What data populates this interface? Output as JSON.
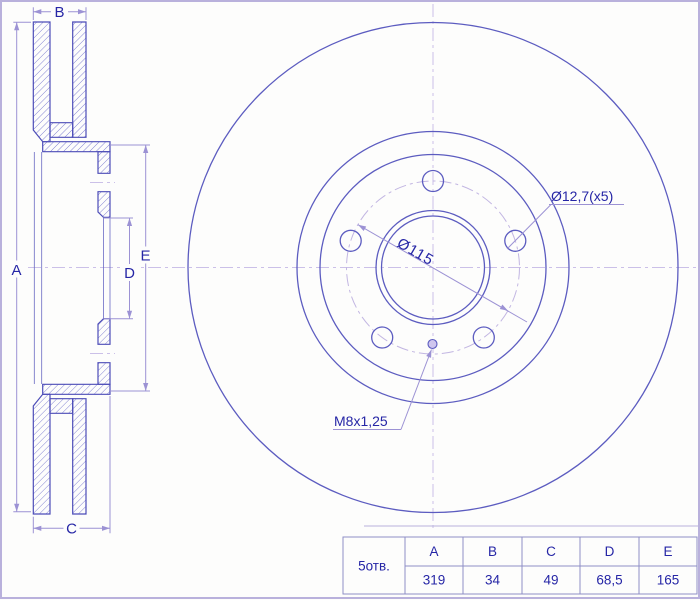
{
  "section_view": {
    "labels": {
      "a": "A",
      "b": "B",
      "c": "C",
      "d": "D",
      "e": "E"
    }
  },
  "front_view": {
    "pcd_diameter_label": "Ø115",
    "bolt_holes_label": "Ø12,7(x5)",
    "set_screw_label": "M8x1,25"
  },
  "spec_table": {
    "row_label": "5отв.",
    "headers": [
      "A",
      "B",
      "C",
      "D",
      "E"
    ],
    "values": [
      "319",
      "34",
      "49",
      "68,5",
      "165"
    ]
  },
  "colors": {
    "background": "#fdfdfc",
    "frame": "#b9b1dc",
    "outline": "#4d4db8",
    "circle": "#5c5cc0",
    "hatch": "#7b7bd0",
    "dimension": "#9c92d4",
    "centerline": "#cbc0e8",
    "text": "#2626a6",
    "table_border": "#8f8fc6"
  }
}
